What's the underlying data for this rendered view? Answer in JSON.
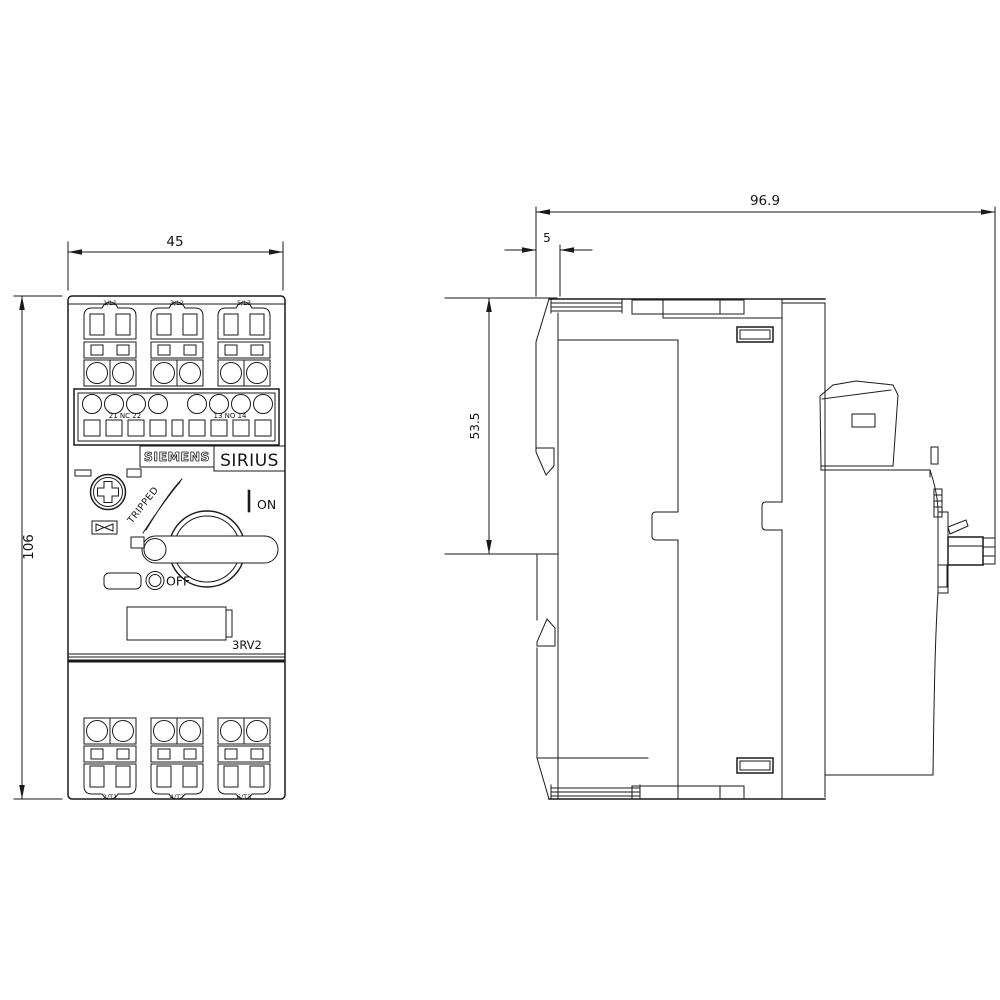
{
  "drawing": {
    "views": {
      "front": {
        "dim_width": "45",
        "dim_height": "106",
        "top_terminals": [
          "1/L1",
          "3/L2",
          "5/L3"
        ],
        "bottom_terminals": [
          "2/T1",
          "4/T2",
          "6/T3"
        ],
        "aux_labels": {
          "left": "21 NC 22",
          "right": "13 NO 14"
        },
        "brand": "SIEMENS",
        "series": "SIRIUS",
        "model": "3RV2",
        "switch": {
          "tripped": "TRIPPED",
          "on": "ON",
          "off": "OFF"
        }
      },
      "side": {
        "dim_depth": "96.9",
        "dim_din_offset": "5",
        "dim_height_upper": "53.5"
      }
    },
    "colors": {
      "line": "#1a1a1a",
      "background": "#ffffff"
    }
  }
}
